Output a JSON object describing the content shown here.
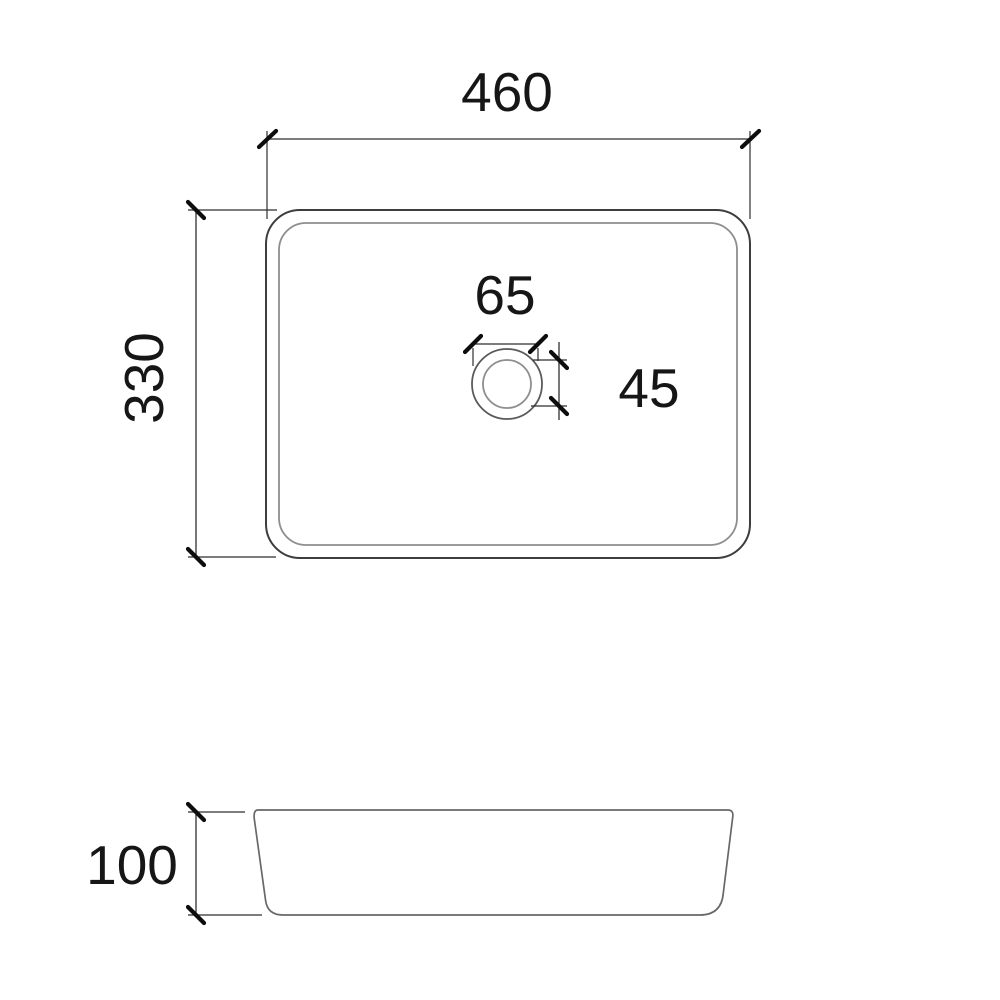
{
  "drawing": {
    "top_view": {
      "outer_width": "460",
      "outer_depth": "330",
      "drain_flange_diameter": "65",
      "drain_hole_diameter": "45"
    },
    "side_view": {
      "height": "100"
    },
    "colors": {
      "line_primary": "#3d3d3d",
      "line_secondary": "#8e8e8e",
      "drain_outline": "#5a5a5a",
      "side_outline": "#686868",
      "dimension_line": "#2f2f2f",
      "tick": "#0d0d0d",
      "text": "#161616",
      "background": "#ffffff"
    }
  }
}
